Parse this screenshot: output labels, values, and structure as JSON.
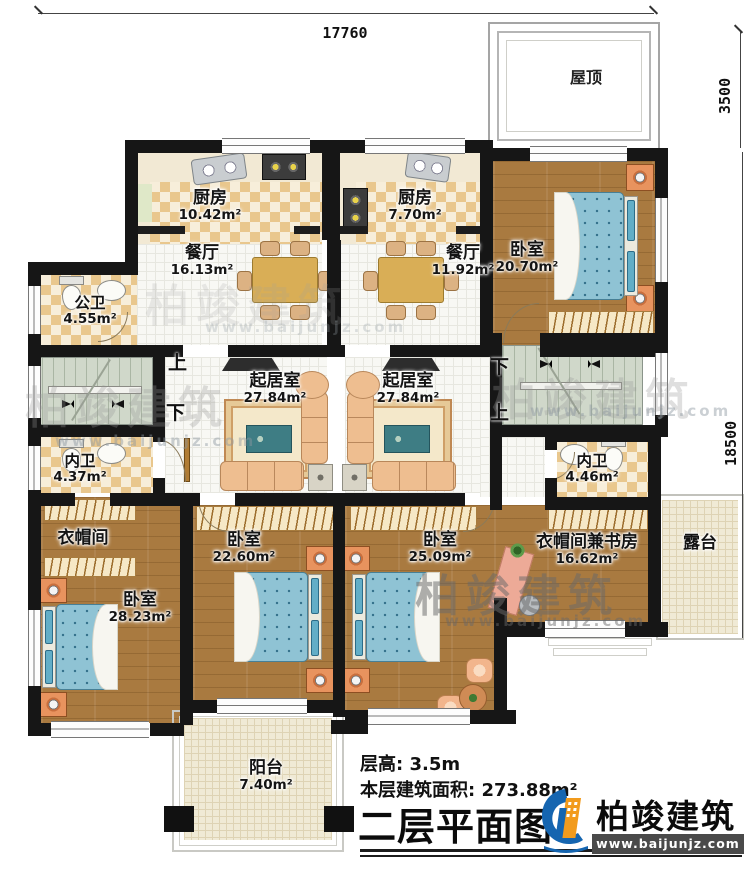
{
  "dimensions": {
    "width_top": "17760",
    "depth_roof": "3500",
    "depth_right": "18500"
  },
  "stairs": {
    "up": "上",
    "down": "下"
  },
  "rooms": {
    "roof": {
      "name": "屋顶"
    },
    "kitchen_left": {
      "name": "厨房",
      "area": "10.42m²"
    },
    "kitchen_right": {
      "name": "厨房",
      "area": "7.70m²"
    },
    "dining_left": {
      "name": "餐厅",
      "area": "16.13m²"
    },
    "dining_right": {
      "name": "餐厅",
      "area": "11.92m²"
    },
    "public_bath": {
      "name": "公卫",
      "area": "4.55m²"
    },
    "bedroom_topright": {
      "name": "卧室",
      "area": "20.70m²"
    },
    "living_left": {
      "name": "起居室",
      "area": "27.84m²"
    },
    "living_right": {
      "name": "起居室",
      "area": "27.84m²"
    },
    "bath_left": {
      "name": "内卫",
      "area": "4.37m²"
    },
    "bath_right": {
      "name": "内卫",
      "area": "4.46m²"
    },
    "cloak_left": {
      "name": "衣帽间"
    },
    "bedroom_bottomleft": {
      "name": "卧室",
      "area": "28.23m²"
    },
    "bedroom_bottommid": {
      "name": "卧室",
      "area": "22.60m²"
    },
    "bedroom_bottomright": {
      "name": "卧室",
      "area": "25.09m²"
    },
    "study": {
      "name": "衣帽间兼书房",
      "area": "16.62m²"
    },
    "terrace": {
      "name": "露台"
    },
    "balcony": {
      "name": "阳台",
      "area": "7.40m²"
    }
  },
  "watermark": {
    "brand": "柏竣建筑",
    "url": "www.baijunjz.com"
  },
  "footer": {
    "floor_height": "层高: 3.5m",
    "floor_area": "本层建筑面积: 273.88m²",
    "title": "二层平面图",
    "brand": "柏竣建筑",
    "brand_url": "www.baijunjz.com"
  },
  "colors": {
    "wall": "#161616",
    "wood": "#a97a40",
    "checker_tile": "#e9c78d",
    "stair": "#d0d8ca",
    "bed": "#8fc3d4",
    "logo_blue": "#1565b0",
    "logo_orange": "#f29b1d"
  }
}
